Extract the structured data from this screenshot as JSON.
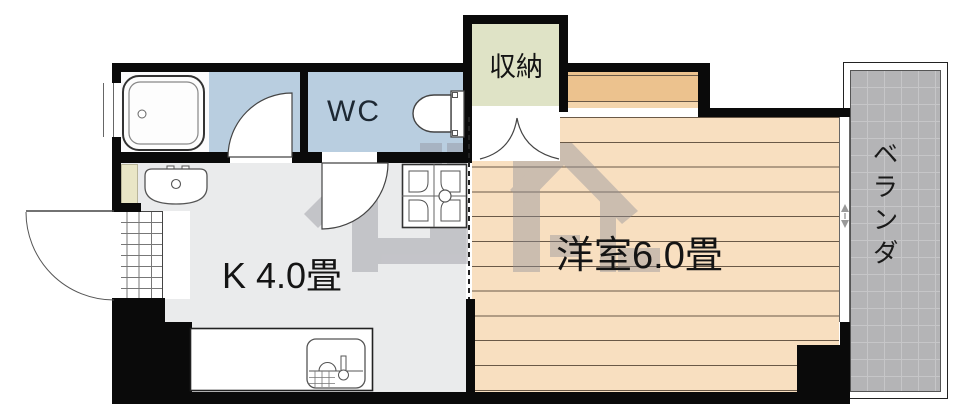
{
  "type": "apartment-floor-plan",
  "labels": {
    "wc": "WC",
    "storage": "収納",
    "kitchen": "K 4.0畳",
    "western_room": "洋室6.0畳",
    "veranda": "ベランダ"
  },
  "rooms": [
    {
      "name": "kitchen",
      "label": "K 4.0畳"
    },
    {
      "name": "western-room",
      "label": "洋室6.0畳"
    },
    {
      "name": "wc",
      "label": "WC"
    },
    {
      "name": "storage-closet",
      "label": "収納"
    },
    {
      "name": "veranda",
      "label": "ベランダ"
    },
    {
      "name": "bathroom",
      "label": ""
    },
    {
      "name": "entrance",
      "label": ""
    }
  ],
  "fixtures": [
    "bathtub-icon",
    "washbasin-icon",
    "toilet-icon",
    "washing-machine-pan-icon",
    "kitchen-sink-icon",
    "entrance-door-swing",
    "washroom-door-swing",
    "wc-door-swing",
    "closet-double-doors",
    "veranda-sliding-window",
    "exterior-window",
    "entrance-tile-grid",
    "company-watermark-logo"
  ],
  "colors": {
    "wall": "#0a0a0a",
    "water_rooms_blue": "#b9cee0",
    "flooring_peach": "#f8dfc0",
    "flooring_line": "#6a5947",
    "alcove_peach": "#ecc28e",
    "storage_green": "#dfe3c6",
    "veranda_gray": "#b4b4b6",
    "kitchen_gray": "#eaebec",
    "pipe_space_cream": "#e9e6c6",
    "watermark_gray": "#8f8f99",
    "label_text": "#141414"
  }
}
